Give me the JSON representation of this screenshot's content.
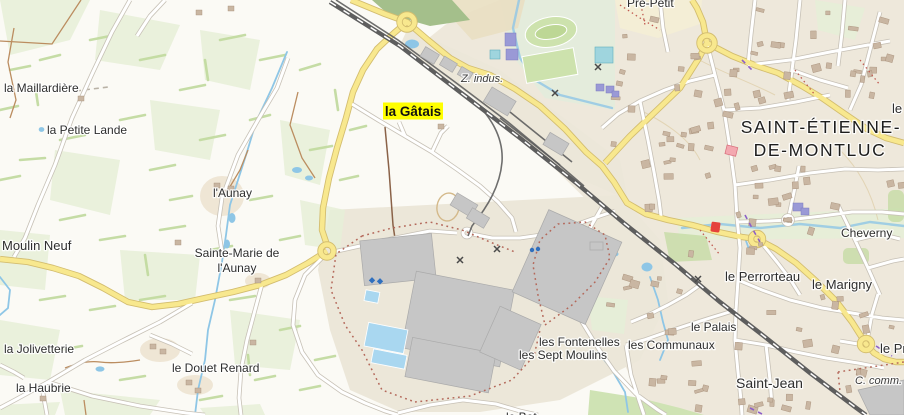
{
  "map": {
    "kind": "topographic web map",
    "highlighted_place": "la Gâtais"
  },
  "labels": {
    "la_maillardiere": "la Maillardière",
    "la_petite_lande": "la Petite Lande",
    "l_aunay": "l'Aunay",
    "moulin_neuf": "Moulin Neuf",
    "sainte_marie_1": "Sainte-Marie de",
    "sainte_marie_2": "l'Aunay",
    "la_jolivetterie": "la Jolivetterie",
    "la_haubrie": "la Haubrie",
    "le_douet_renard": "le Douet Renard",
    "la_gatais": "la Gâtais",
    "z_indus": "Z. indus.",
    "pre_petit": "Pré-Petit",
    "town_1": "SAINT-ÉTIENNE-",
    "town_2": "DE-MONTLUC",
    "le_edge": "le",
    "cheverny": "Cheverny",
    "le_perrorteau": "le Perrorteau",
    "le_marigny": "le Marigny",
    "le_palais": "le Palais",
    "les_communaux": "les Communaux",
    "les_fontenelles": "les Fontenelles",
    "les_sept_moulins": "les Sept Moulins",
    "saint_jean": "Saint-Jean",
    "c_comm": "C. comm.",
    "le_pr_edge": "le Pr",
    "le_bot_edge": "le Bot"
  },
  "colors": {
    "rural_bg": "#fbfaf5",
    "town_bg": "#eee8db",
    "indus_bg": "#ece7d9",
    "park_bg": "#f4eed6",
    "green_field": "#e6eed7",
    "green_hedge": "#c3dba1",
    "forest": "#a4bf8b",
    "sports_green": "#cde2ad",
    "water": "#8ec6e6",
    "water_fill": "#a9d7f0",
    "road_white": "#ffffff",
    "road_casing": "#c7c1b6",
    "road_yellow": "#f8e88e",
    "road_casing_yellow": "#d3bd6f",
    "railway": "#5e5e5e",
    "building": "#c9b6a2",
    "building_stroke": "#a68e78",
    "factory": "#c6c6c6",
    "purple_building": "#9a99d6",
    "pink_building": "#f3a8b0",
    "red_poi": "#e5423b",
    "boundary_dots": "#b4685a",
    "path_brown": "#bb8d60",
    "purple_dash": "#8d5fc8",
    "label": "#2e2e2e",
    "town_label": "#1d1d1d",
    "highlight": "#ffff00"
  }
}
